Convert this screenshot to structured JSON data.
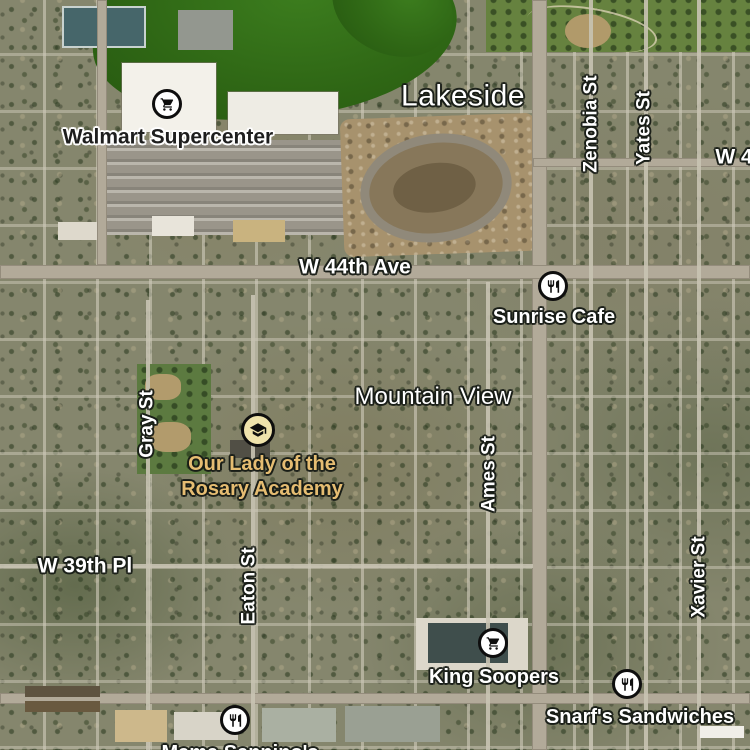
{
  "map": {
    "imagery_type": "satellite",
    "labels": {
      "town": {
        "lakeside": "Lakeside"
      },
      "areas": {
        "mountain_view": "Mountain View"
      },
      "roads": {
        "w44th_ave": "W 44th Ave",
        "w39th_pl": "W 39th Pl",
        "w4_partial": "W 4"
      },
      "streets": {
        "gray": "Gray St",
        "zenobia": "Zenobia St",
        "yates": "Yates St",
        "ames": "Ames St",
        "eaton": "Eaton St",
        "xavier": "Xavier St"
      },
      "pois": {
        "walmart": {
          "name": "Walmart Supercenter",
          "icon": "shopping-cart-icon"
        },
        "sunrise_cafe": {
          "name": "Sunrise Cafe",
          "icon": "restaurant-icon"
        },
        "rosary_academy": {
          "name_line1": "Our Lady of the",
          "name_line2": "Rosary Academy",
          "icon": "school-icon"
        },
        "king_soopers": {
          "name": "King Soopers",
          "icon": "shopping-cart-icon"
        },
        "snarfs": {
          "name": "Snarf's Sandwiches",
          "icon": "restaurant-icon"
        },
        "mama_sanninos": {
          "name": "Mama Sannino's",
          "icon": "restaurant-icon"
        }
      }
    },
    "colors": {
      "poi_icon_ring": "#0e0e0e",
      "poi_icon_bg": "#ffffff",
      "school_icon_bg": "#efe3ac",
      "school_label_text": "#e6bd72",
      "label_white": "#ffffff",
      "label_dark": "#1e1e1e",
      "lake_green": "#2f6715",
      "park_green": "#66823f",
      "road_gray": "#b2aa99",
      "dirt_tan": "#a7926d"
    }
  }
}
